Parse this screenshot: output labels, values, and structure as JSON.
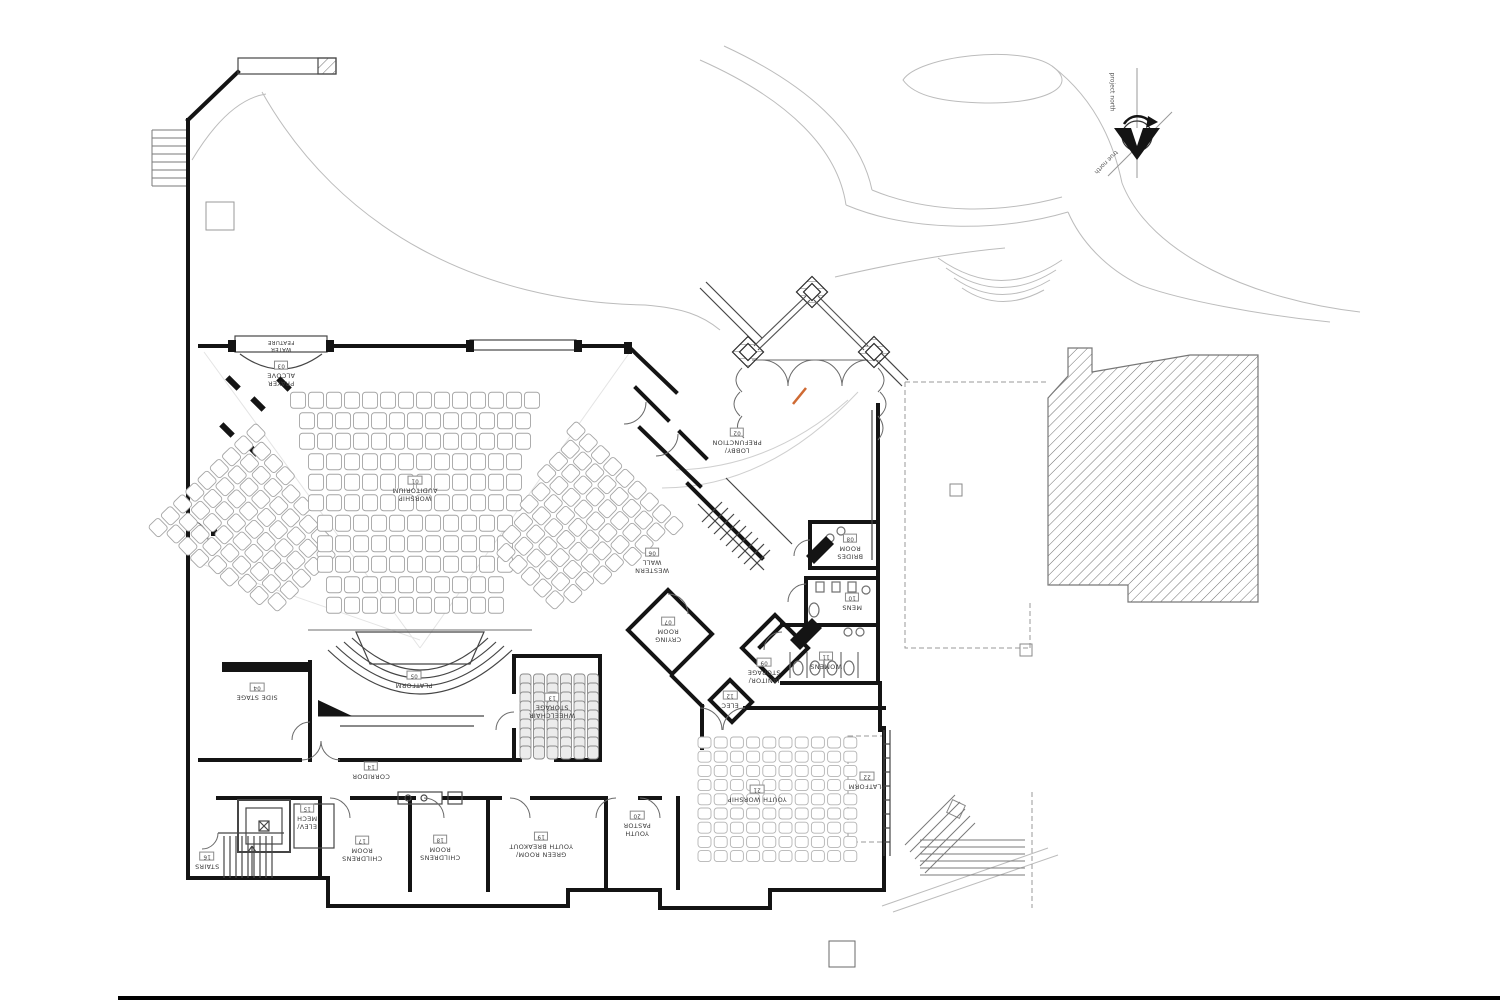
{
  "meta": {
    "sheet_type": "architectural first-floor plan",
    "building": "church / worship facility"
  },
  "colors": {
    "wall": "#141414",
    "thin_line": "#454545",
    "door": "#6a6a6a",
    "site_line": "#bcbcbc",
    "dashed_line": "#9a9a9a",
    "hatch": "#6f6f6f",
    "seat_outline": "#a5a5a5",
    "youth_seat_outline": "#b4b4b4",
    "stack_chair_fill": "#ececec",
    "stack_chair_stroke": "#8a8a8a",
    "accent_orange": "#cf6a33",
    "label_text": "#3a3a3a",
    "page_rule": "#000000"
  },
  "compass": {
    "project_north_label": "project north",
    "true_north_label": "true north"
  },
  "rooms": [
    {
      "id": "water-feature",
      "x": 281,
      "y": 345,
      "lines": [
        "WATER",
        "FEATURE"
      ],
      "num": null,
      "size": 5.5
    },
    {
      "id": "prayer-alcove",
      "x": 281,
      "y": 374,
      "lines": [
        "PRAYER",
        "ALCOVE"
      ],
      "num": "03"
    },
    {
      "id": "worship-auditorium",
      "x": 415,
      "y": 489,
      "lines": [
        "WORSHIP",
        "AUDITORIUM"
      ],
      "num": "01"
    },
    {
      "id": "lobby-prefunction",
      "x": 737,
      "y": 441,
      "lines": [
        "LOBBY/",
        "PREFUNCTION"
      ],
      "num": "02"
    },
    {
      "id": "western-wall",
      "x": 652,
      "y": 561,
      "lines": [
        "WESTERN",
        "WALL"
      ],
      "num": "06"
    },
    {
      "id": "crying-room",
      "x": 668,
      "y": 630,
      "lines": [
        "CRYING",
        "ROOM"
      ],
      "num": "07"
    },
    {
      "id": "brides-room",
      "x": 850,
      "y": 547,
      "lines": [
        "BRIDES",
        "ROOM"
      ],
      "num": "08"
    },
    {
      "id": "mens",
      "x": 852,
      "y": 602,
      "lines": [
        "MENS"
      ],
      "num": "10"
    },
    {
      "id": "womens",
      "x": 826,
      "y": 661,
      "lines": [
        "WOMENS"
      ],
      "num": "11"
    },
    {
      "id": "janitor-storage",
      "x": 764,
      "y": 671,
      "lines": [
        "JANITOR/",
        "STORAGE"
      ],
      "num": "09"
    },
    {
      "id": "elec",
      "x": 730,
      "y": 700,
      "lines": [
        "ELEC"
      ],
      "num": "12"
    },
    {
      "id": "side-stage",
      "x": 257,
      "y": 692,
      "lines": [
        "SIDE STAGE"
      ],
      "num": "04"
    },
    {
      "id": "platform-main",
      "x": 414,
      "y": 680,
      "lines": [
        "PLATFORM"
      ],
      "num": "05"
    },
    {
      "id": "wheelchair-storage",
      "x": 552,
      "y": 706,
      "lines": [
        "WHEELCHAIR",
        "STORAGE"
      ],
      "num": "13"
    },
    {
      "id": "corridor",
      "x": 371,
      "y": 771,
      "lines": [
        "CORRIDOR"
      ],
      "num": "14"
    },
    {
      "id": "elev-mech",
      "x": 307,
      "y": 817,
      "lines": [
        "ELEV/",
        "MECH"
      ],
      "num": "15"
    },
    {
      "id": "stairs",
      "x": 207,
      "y": 861,
      "lines": [
        "STAIRS"
      ],
      "num": "16"
    },
    {
      "id": "childrens-room-1",
      "x": 362,
      "y": 849,
      "lines": [
        "CHILDRENS",
        "ROOM"
      ],
      "num": "17"
    },
    {
      "id": "childrens-room-2",
      "x": 440,
      "y": 848,
      "lines": [
        "CHILDRENS",
        "ROOM"
      ],
      "num": "18"
    },
    {
      "id": "green-room-youth-breakout",
      "x": 541,
      "y": 845,
      "lines": [
        "GREEN ROOM/",
        "YOUTH BREAKOUT"
      ],
      "num": "19"
    },
    {
      "id": "youth-pastor",
      "x": 637,
      "y": 824,
      "lines": [
        "YOUTH",
        "PASTOR"
      ],
      "num": "20"
    },
    {
      "id": "youth-worship",
      "x": 757,
      "y": 794,
      "lines": [
        "YOUTH WORSHIP"
      ],
      "num": "21"
    },
    {
      "id": "platform-youth",
      "x": 867,
      "y": 781,
      "lines": [
        "PLATFORM"
      ],
      "num": "22"
    }
  ],
  "seating": {
    "auditorium": {
      "seat_color": "#a5a5a5",
      "sections": [
        {
          "id": "left-wedge",
          "cx": 255,
          "cy": 530,
          "rot": -44,
          "rows": 9,
          "row_gap": 17,
          "seat_w": 14,
          "seat_h": 15,
          "gap": 3,
          "w_start": 150,
          "w_end": 92
        },
        {
          "id": "center-wedge",
          "cx": 415,
          "cy": 505,
          "rot": 0,
          "rows": 11,
          "row_gap": 20.5,
          "seat_w": 15,
          "seat_h": 16,
          "gap": 3,
          "w_start": 245,
          "w_end": 175
        },
        {
          "id": "right-wedge",
          "cx": 577,
          "cy": 528,
          "rot": 44,
          "rows": 9,
          "row_gap": 17,
          "seat_w": 14,
          "seat_h": 15,
          "gap": 3,
          "w_start": 150,
          "w_end": 92
        }
      ]
    },
    "youth_worship": {
      "x0": 698,
      "y0": 737,
      "cols": 10,
      "rows": 9,
      "dx": 16.2,
      "dy": 14.2,
      "w": 13,
      "h": 11,
      "color": "#b4b4b4"
    },
    "chair_storage": {
      "x0": 520,
      "cols": 6,
      "dx": 13.5,
      "w": 11,
      "h": 13,
      "banks": [
        {
          "y0": 674,
          "n": 6,
          "dy": 9
        },
        {
          "y0": 728,
          "n": 3,
          "dy": 9
        }
      ],
      "fill": "#ececec",
      "stroke": "#8a8a8a"
    }
  }
}
